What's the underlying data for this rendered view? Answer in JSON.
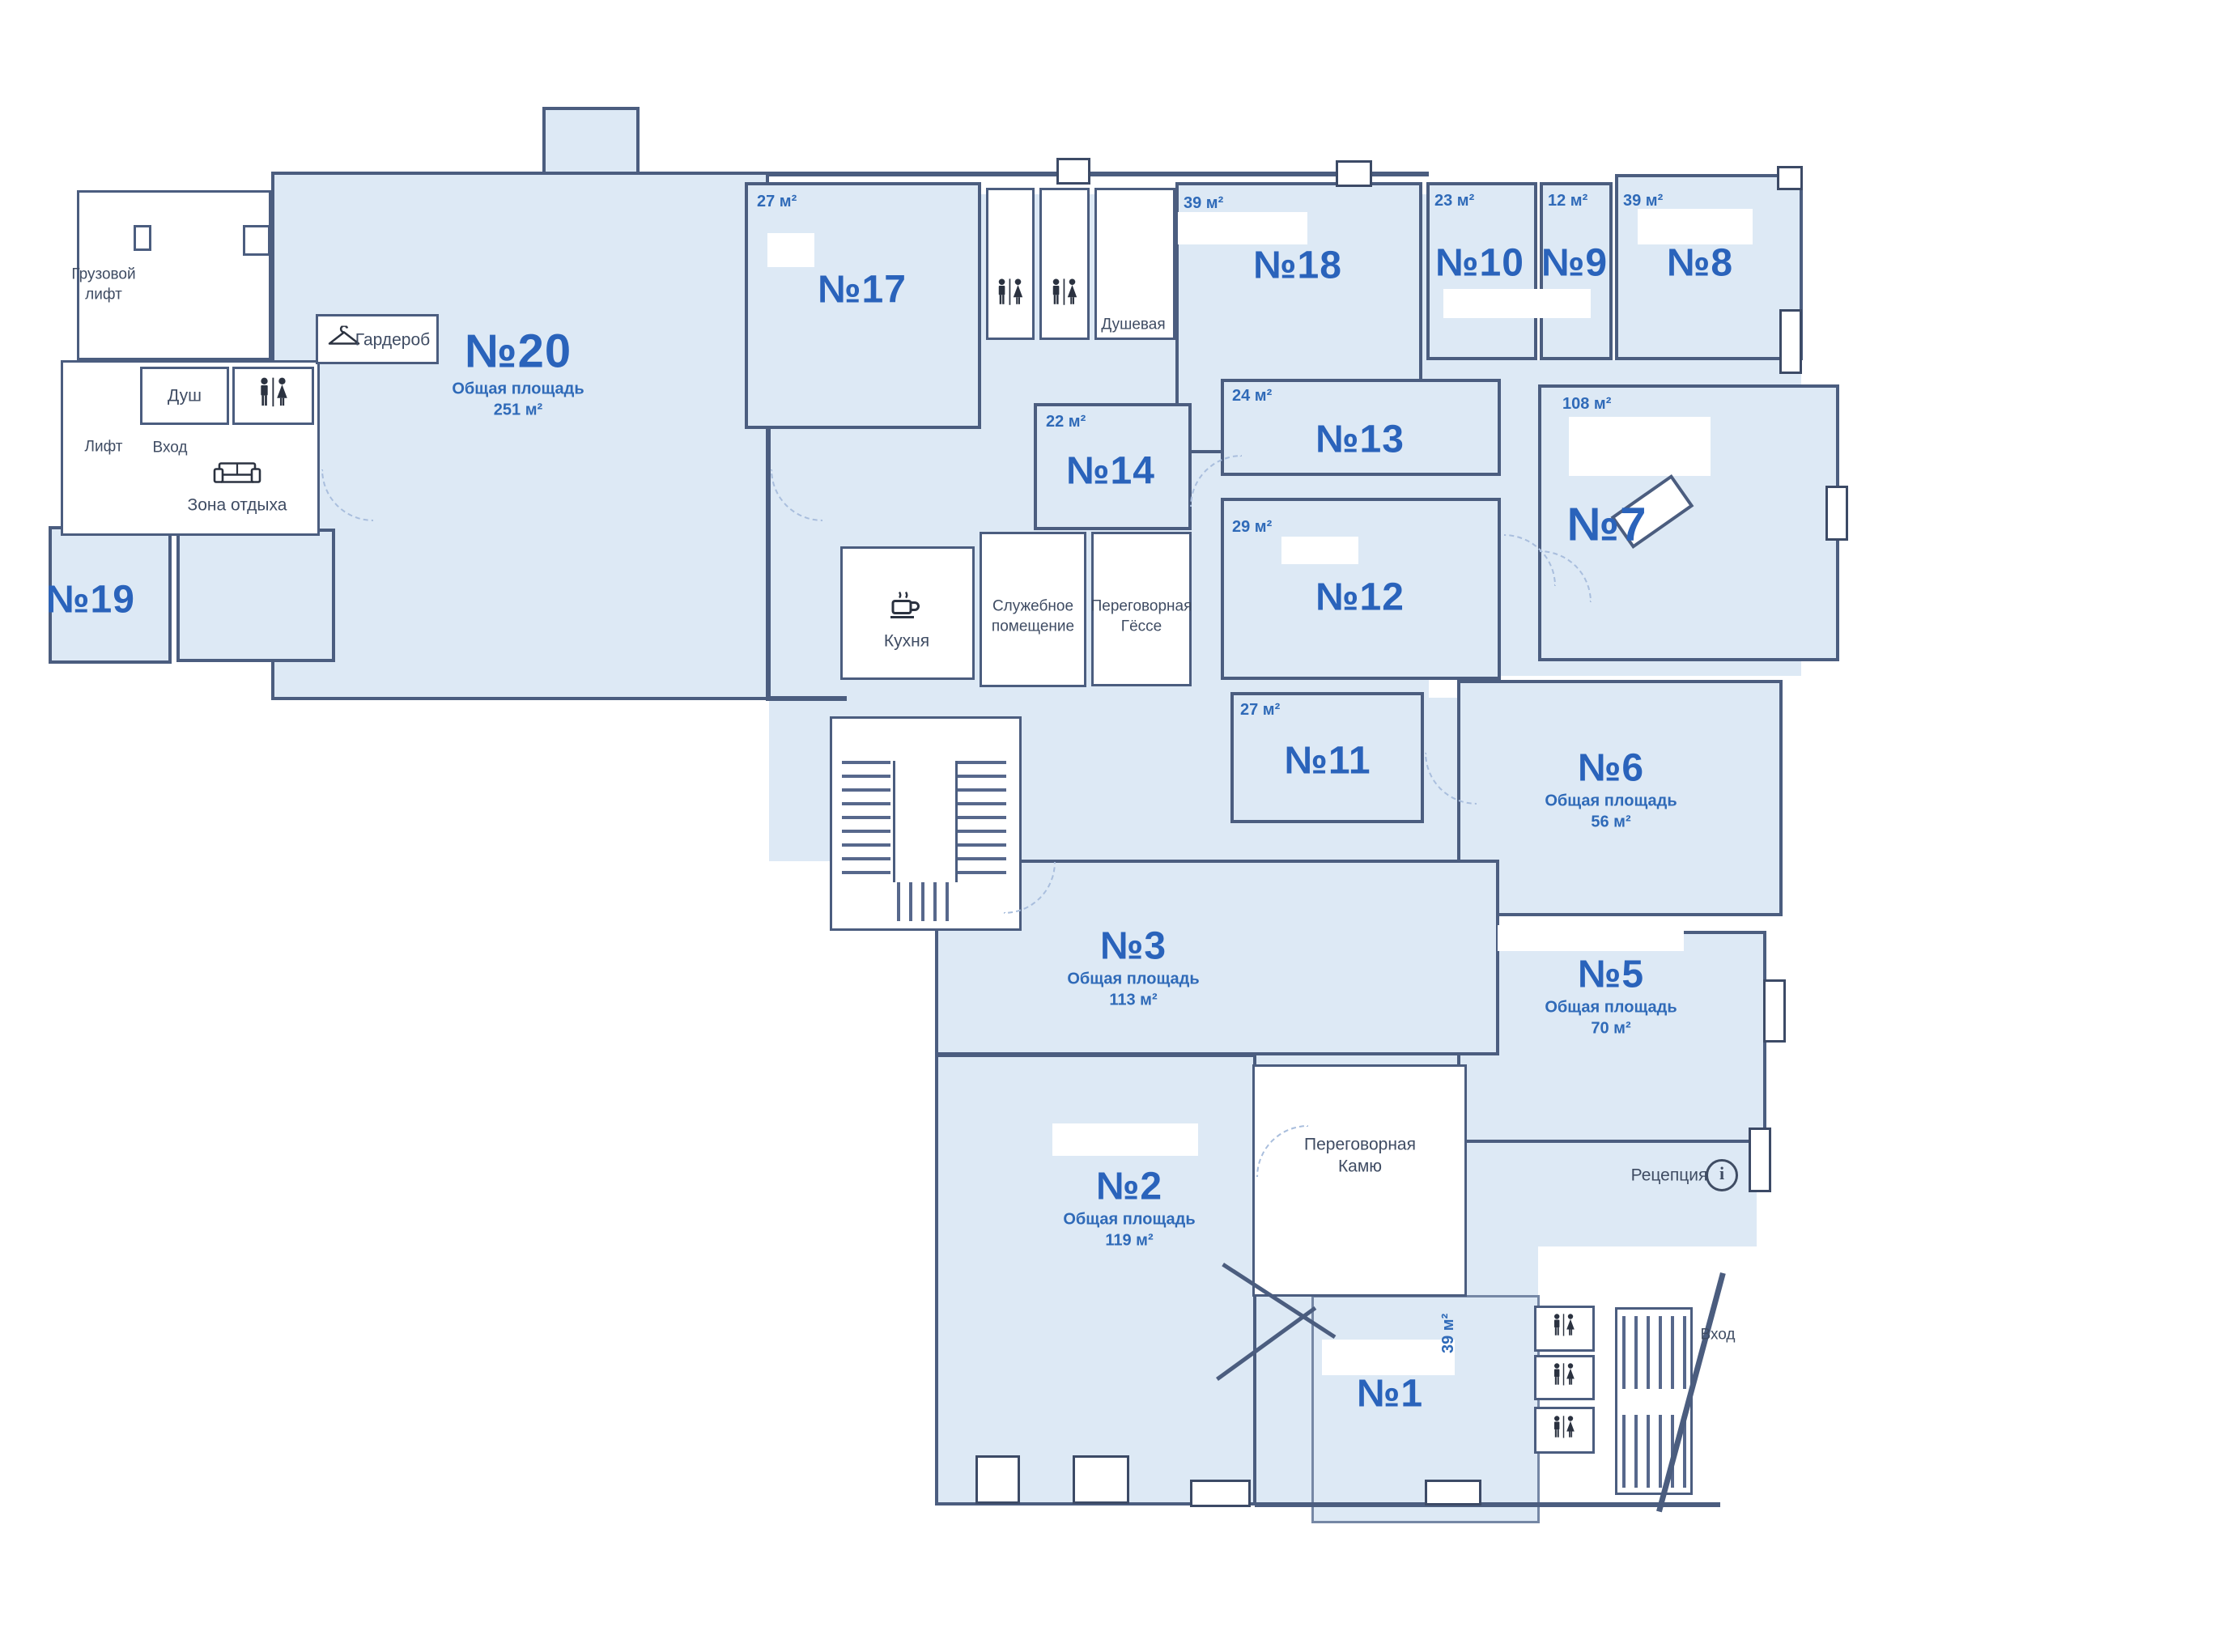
{
  "plan": {
    "rooms": {
      "r1": {
        "num": "№1",
        "area_side": "39 м²"
      },
      "r2": {
        "num": "№2",
        "area_title": "Общая площадь",
        "area_value": "119 м²"
      },
      "r3": {
        "num": "№3",
        "area_title": "Общая площадь",
        "area_value": "113 м²"
      },
      "r5": {
        "num": "№5",
        "area_title": "Общая площадь",
        "area_value": "70 м²"
      },
      "r6": {
        "num": "№6",
        "area_title": "Общая площадь",
        "area_value": "56 м²"
      },
      "r7": {
        "num": "№7",
        "area_value": "108 м²"
      },
      "r8": {
        "num": "№8",
        "area_value": "39 м²"
      },
      "r9": {
        "num": "№9",
        "area_value": "12 м²"
      },
      "r10": {
        "num": "№10",
        "area_value": "23 м²"
      },
      "r11": {
        "num": "№11",
        "area_value": "27 м²"
      },
      "r12": {
        "num": "№12",
        "area_value": "29 м²"
      },
      "r13": {
        "num": "№13",
        "area_value": "24 м²"
      },
      "r14": {
        "num": "№14",
        "area_value": "22 м²"
      },
      "r17": {
        "num": "№17",
        "area_value": "27 м²"
      },
      "r18": {
        "num": "№18",
        "area_value": "39 м²"
      },
      "r19": {
        "num": "№19"
      },
      "r20": {
        "num": "№20",
        "area_title": "Общая площадь",
        "area_value": "251 м²"
      }
    },
    "facilities": {
      "freight_elevator_line1": "Грузовой",
      "freight_elevator_line2": "лифт",
      "wardrobe": "Гардероб",
      "shower": "Душ",
      "elevator": "Лифт",
      "entrance": "Вход",
      "rest_zone": "Зона отдыха",
      "shower_room": "Душевая",
      "kitchen": "Кухня",
      "service_room_line1": "Служебное",
      "service_room_line2": "помещение",
      "meeting_gesse_line1": "Переговорная",
      "meeting_gesse_line2": "Гёссе",
      "meeting_kamyu_line1": "Переговорная",
      "meeting_kamyu_line2": "Камю",
      "reception": "Рецепция",
      "entrance_bottom": "Вход",
      "info_glyph": "i"
    },
    "colors": {
      "floor_fill": "#dde9f5",
      "wall": "#4b5d7f",
      "room_number": "#2a63bb",
      "secondary_text": "#3f4c63"
    }
  }
}
